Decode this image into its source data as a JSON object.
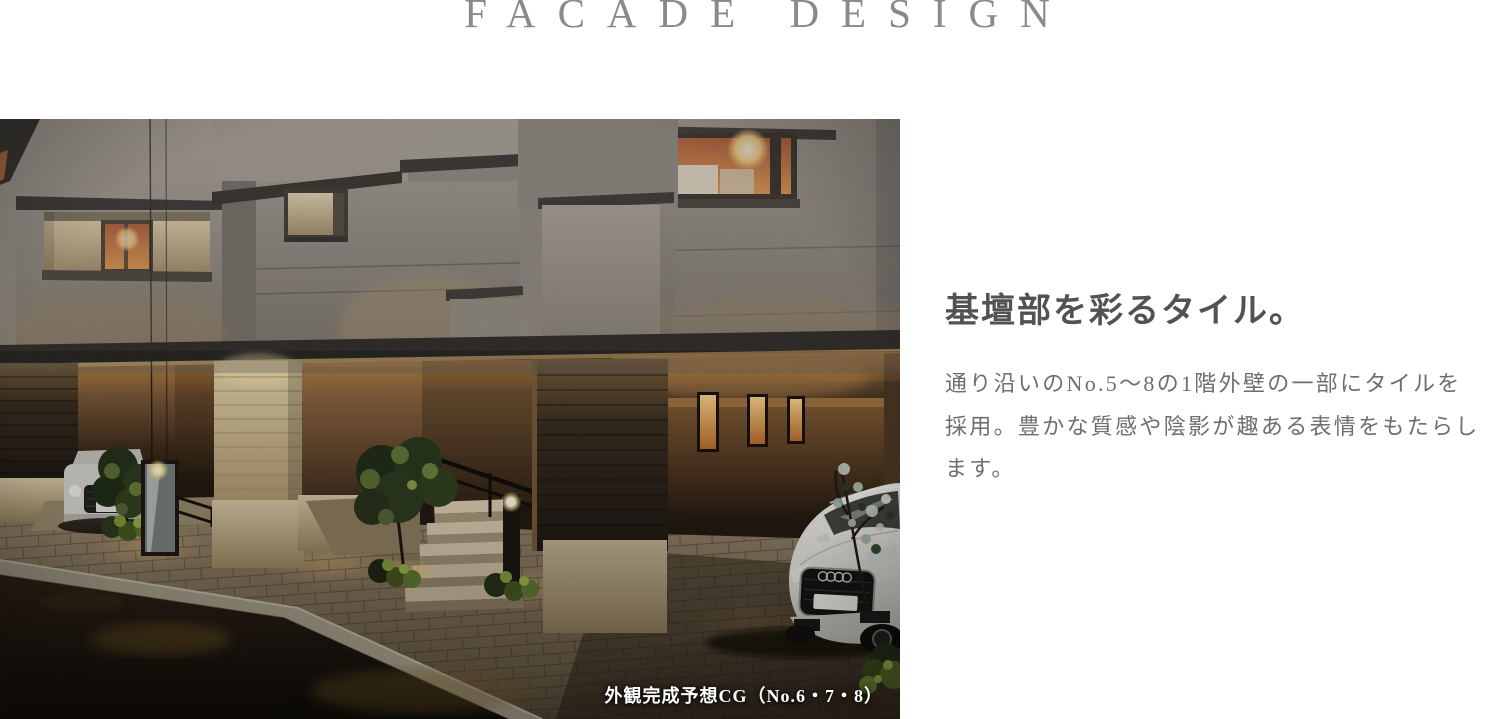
{
  "page": {
    "background": "#ffffff"
  },
  "header": {
    "title": "FACADE DESIGN"
  },
  "article": {
    "heading": "基壇部を彩るタイル。",
    "body_lines": [
      "通り沿いのNo.5～8の1階外壁の一部にタイルを",
      "採用。豊かな質感や陰影が趣ある表情をもたらし",
      "ます。"
    ]
  },
  "photo": {
    "caption": "外観完成予想CG（No.6・7・8）",
    "palette": {
      "warm_light": "#f2b45e",
      "stucco_gray": "#948c82",
      "tile_brown": "#8a6540",
      "stone_beige": "#d8c5a0",
      "night_road": "#17110c"
    }
  }
}
